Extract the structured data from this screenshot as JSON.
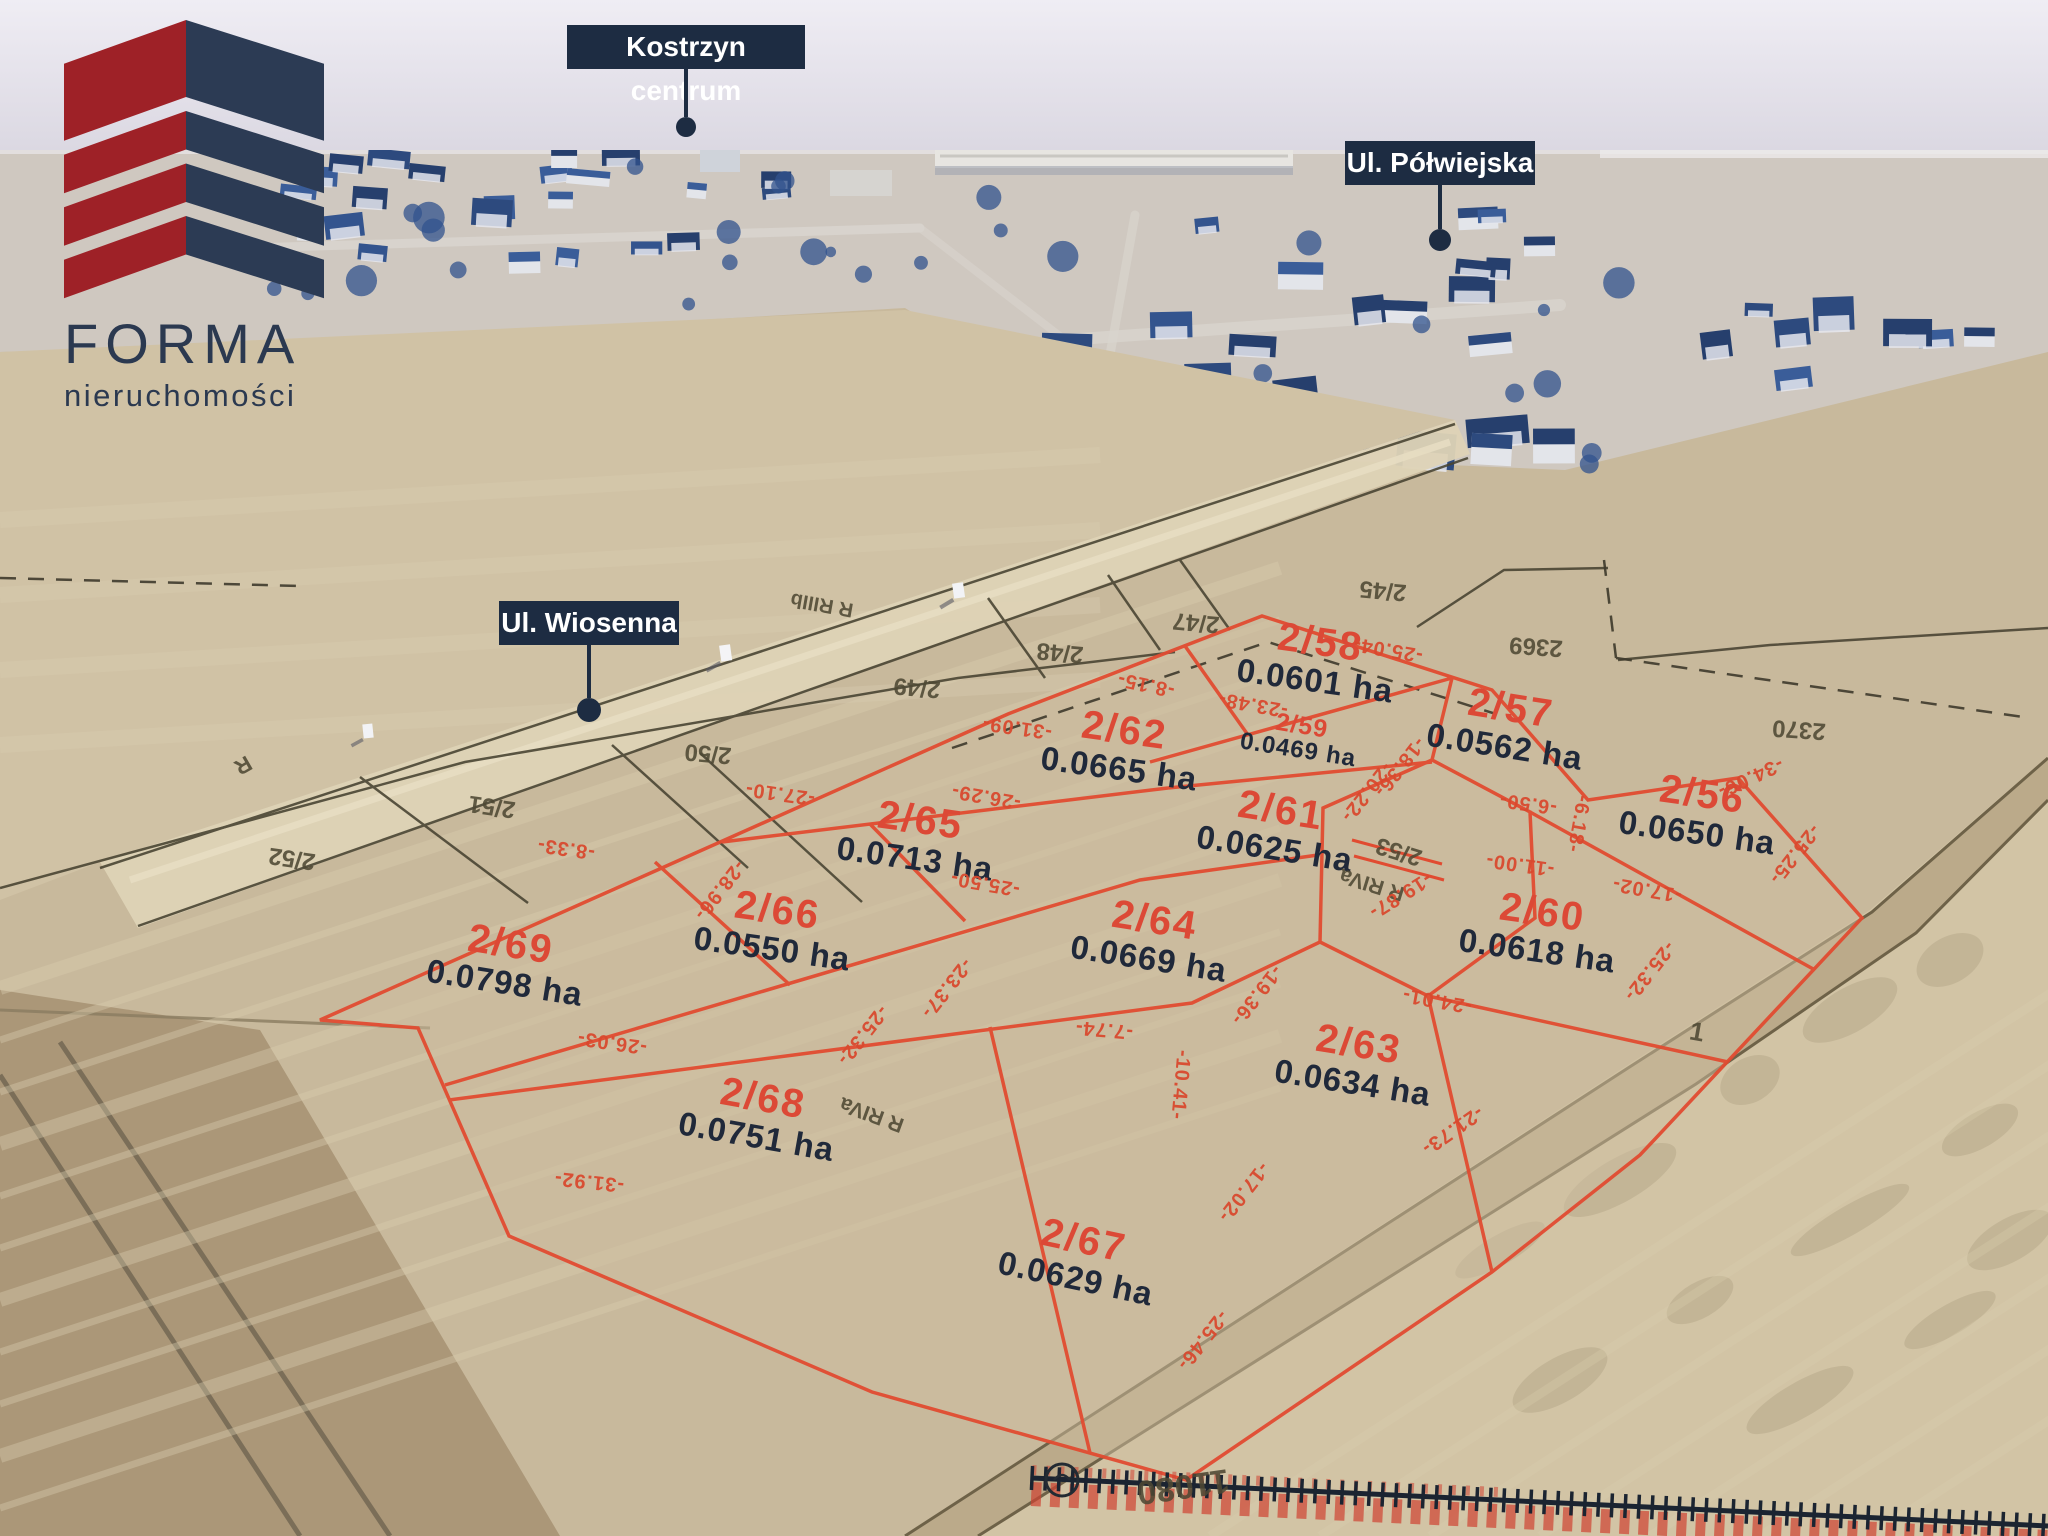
{
  "brand": {
    "name": "FORMA",
    "tagline": "nieruchomości"
  },
  "location_labels": [
    {
      "id": "kostrzyn-centrum",
      "text": "Kostrzyn centrum",
      "x": 567,
      "y": 25,
      "w": 238,
      "h": 44,
      "line": 48,
      "r": 10
    },
    {
      "id": "ul-polwiejska",
      "text": "Ul. Półwiejska",
      "x": 1345,
      "y": 141,
      "w": 190,
      "h": 44,
      "line": 44,
      "r": 11
    },
    {
      "id": "ul-wiosenna",
      "text": "Ul. Wiosenna",
      "x": 499,
      "y": 601,
      "w": 180,
      "h": 44,
      "line": 53,
      "r": 12
    }
  ],
  "plots": [
    {
      "number": "2/58",
      "area": "0.0601 ha",
      "x": 1318,
      "y": 660,
      "rot": 8
    },
    {
      "number": "2/59",
      "area": "0.0469 ha",
      "x": 1300,
      "y": 738,
      "rot": 9,
      "small": true
    },
    {
      "number": "2/57",
      "area": "0.0562 ha",
      "x": 1508,
      "y": 726,
      "rot": 9
    },
    {
      "number": "2/56",
      "area": "0.0650 ha",
      "x": 1700,
      "y": 812,
      "rot": 8
    },
    {
      "number": "2/62",
      "area": "0.0665 ha",
      "x": 1122,
      "y": 748,
      "rot": 8
    },
    {
      "number": "2/65",
      "area": "0.0713 ha",
      "x": 918,
      "y": 838,
      "rot": 8
    },
    {
      "number": "2/61",
      "area": "0.0625 ha",
      "x": 1278,
      "y": 828,
      "rot": 9
    },
    {
      "number": "2/66",
      "area": "0.0550 ha",
      "x": 775,
      "y": 928,
      "rot": 8
    },
    {
      "number": "2/64",
      "area": "0.0669 ha",
      "x": 1152,
      "y": 938,
      "rot": 9
    },
    {
      "number": "2/60",
      "area": "0.0618 ha",
      "x": 1540,
      "y": 930,
      "rot": 8
    },
    {
      "number": "2/69",
      "area": "0.0798 ha",
      "x": 508,
      "y": 962,
      "rot": 9
    },
    {
      "number": "2/63",
      "area": "0.0634 ha",
      "x": 1356,
      "y": 1062,
      "rot": 9
    },
    {
      "number": "2/68",
      "area": "0.0751 ha",
      "x": 760,
      "y": 1116,
      "rot": 10
    },
    {
      "number": "2/67",
      "area": "0.0629 ha",
      "x": 1080,
      "y": 1258,
      "rot": 12
    }
  ],
  "parcels": [
    {
      "text": "R",
      "x": 243,
      "y": 765,
      "rot": 150,
      "size": 22
    },
    {
      "text": "2/52",
      "x": 292,
      "y": 858,
      "rot": 188,
      "size": 24
    },
    {
      "text": "2/51",
      "x": 492,
      "y": 806,
      "rot": 188,
      "size": 24
    },
    {
      "text": "2/50",
      "x": 708,
      "y": 753,
      "rot": 185,
      "size": 24
    },
    {
      "text": "R RIIIb",
      "x": 822,
      "y": 604,
      "rot": 190,
      "size": 20
    },
    {
      "text": "2/49",
      "x": 917,
      "y": 687,
      "rot": 185,
      "size": 24
    },
    {
      "text": "2/48",
      "x": 1060,
      "y": 652,
      "rot": 185,
      "size": 24
    },
    {
      "text": "2/47",
      "x": 1196,
      "y": 622,
      "rot": 185,
      "size": 24
    },
    {
      "text": "2/45",
      "x": 1383,
      "y": 590,
      "rot": 185,
      "size": 24
    },
    {
      "text": "2369",
      "x": 1536,
      "y": 646,
      "rot": 184,
      "size": 24
    },
    {
      "text": "2370",
      "x": 1799,
      "y": 729,
      "rot": 184,
      "size": 24
    },
    {
      "text": "2/53",
      "x": 1399,
      "y": 851,
      "rot": 197,
      "size": 24
    },
    {
      "text": "R RIVa",
      "x": 1372,
      "y": 884,
      "rot": 197,
      "size": 21
    },
    {
      "text": "R RIVa",
      "x": 872,
      "y": 1114,
      "rot": 200,
      "size": 21
    },
    {
      "text": "1",
      "x": 1697,
      "y": 1032,
      "rot": 10,
      "size": 26
    },
    {
      "text": "11080",
      "x": 1183,
      "y": 1486,
      "rot": 172,
      "size": 34
    }
  ],
  "dimensions": [
    {
      "t": "-8.33-",
      "x": 566,
      "y": 848,
      "r": 188
    },
    {
      "t": "-31.09-",
      "x": 1017,
      "y": 727,
      "r": 188
    },
    {
      "t": "-8.15-",
      "x": 1146,
      "y": 684,
      "r": 192
    },
    {
      "t": "-25.04-",
      "x": 1388,
      "y": 649,
      "r": 190
    },
    {
      "t": "-23.48-",
      "x": 1253,
      "y": 704,
      "r": 190
    },
    {
      "t": "-18.36-",
      "x": 1399,
      "y": 767,
      "r": 128
    },
    {
      "t": "-20.22-",
      "x": 1366,
      "y": 792,
      "r": 128
    },
    {
      "t": "-6.50-",
      "x": 1528,
      "y": 803,
      "r": 188
    },
    {
      "t": "-6.18-",
      "x": 1578,
      "y": 824,
      "r": 100
    },
    {
      "t": "-27.10-",
      "x": 780,
      "y": 793,
      "r": 188
    },
    {
      "t": "-26.29-",
      "x": 986,
      "y": 796,
      "r": 190
    },
    {
      "t": "-25.50-",
      "x": 985,
      "y": 883,
      "r": 190
    },
    {
      "t": "-28.96-",
      "x": 719,
      "y": 890,
      "r": 128
    },
    {
      "t": "-25.32-",
      "x": 862,
      "y": 1035,
      "r": 128
    },
    {
      "t": "-26.03-",
      "x": 612,
      "y": 1042,
      "r": 188
    },
    {
      "t": "-31.92-",
      "x": 589,
      "y": 1181,
      "r": 186
    },
    {
      "t": "-23.37-",
      "x": 946,
      "y": 988,
      "r": 128
    },
    {
      "t": "-7.74-",
      "x": 1104,
      "y": 1029,
      "r": 185
    },
    {
      "t": "-19.87-",
      "x": 1400,
      "y": 895,
      "r": 148
    },
    {
      "t": "-19.36-",
      "x": 1256,
      "y": 995,
      "r": 128
    },
    {
      "t": "-24.01-",
      "x": 1437,
      "y": 1000,
      "r": 190
    },
    {
      "t": "-10.41-",
      "x": 1180,
      "y": 1085,
      "r": 95
    },
    {
      "t": "-17.02-",
      "x": 1243,
      "y": 1192,
      "r": 128
    },
    {
      "t": "-21.73-",
      "x": 1452,
      "y": 1130,
      "r": 145
    },
    {
      "t": "-25.46-",
      "x": 1202,
      "y": 1340,
      "r": 128
    },
    {
      "t": "-17.02-",
      "x": 1647,
      "y": 889,
      "r": 190
    },
    {
      "t": "-25.32-",
      "x": 1649,
      "y": 971,
      "r": 128
    },
    {
      "t": "-11.00-",
      "x": 1520,
      "y": 864,
      "r": 188
    },
    {
      "t": "-34.06-",
      "x": 1750,
      "y": 777,
      "r": 155
    },
    {
      "t": "-25.25-",
      "x": 1794,
      "y": 854,
      "r": 128
    }
  ]
}
